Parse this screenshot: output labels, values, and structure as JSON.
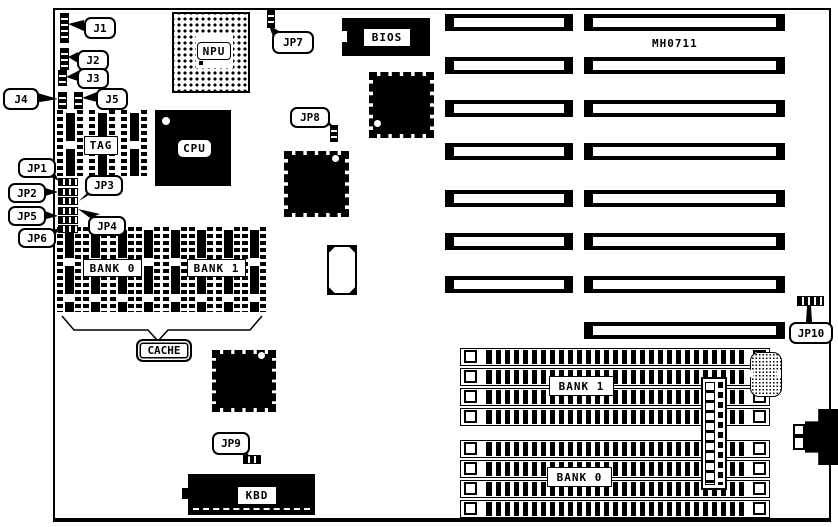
{
  "diagram": {
    "board_id": "MH0711",
    "chips": {
      "npu": "NPU",
      "cpu": "CPU",
      "bios": "BIOS",
      "tag": "TAG",
      "kbd": "KBD"
    },
    "cache": {
      "label": "CACHE",
      "bank0": "BANK 0",
      "bank1": "BANK 1"
    },
    "memory": {
      "bank1": "BANK 1",
      "bank0": "BANK 0"
    },
    "jumpers": {
      "j1": "J1",
      "j2": "J2",
      "j3": "J3",
      "j4": "J4",
      "j5": "J5",
      "jp1": "JP1",
      "jp2": "JP2",
      "jp3": "JP3",
      "jp4": "JP4",
      "jp5": "JP5",
      "jp6": "JP6",
      "jp7": "JP7",
      "jp8": "JP8",
      "jp9": "JP9",
      "jp10": "JP10"
    },
    "colors": {
      "ink": "#000000",
      "paper": "#ffffff"
    }
  }
}
